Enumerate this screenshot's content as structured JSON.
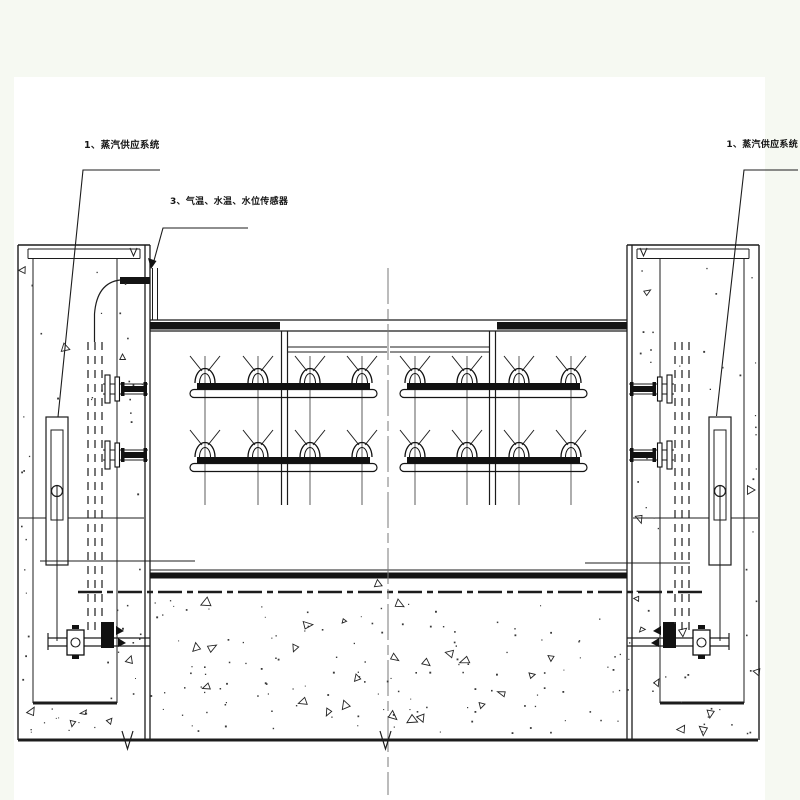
{
  "labels": {
    "steam_left": "1、蒸汽供应系统",
    "sensors": "3、气温、水温、水位传感器",
    "steam_right": "1、蒸汽供应系统"
  },
  "colors": {
    "paper": "#ffffff",
    "margin": "#f6f9f2",
    "ink": "#1c1c1c",
    "centerline": "#787878"
  },
  "diagram": {
    "type": "engineering-section-drawing",
    "spray_pipe_rows": 2,
    "spray_pipe_groups_per_row": 2,
    "nozzles_per_pipe": 4,
    "piers": 2,
    "level_gauges": 2,
    "valves": 2
  }
}
